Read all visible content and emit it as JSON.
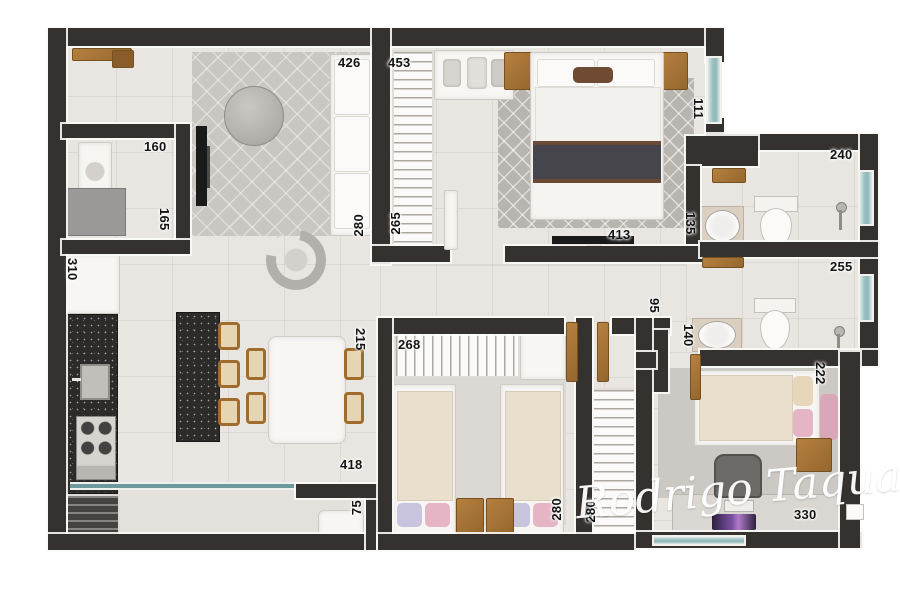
{
  "watermark": "Rodrigo Taquary",
  "colors": {
    "wall": "#35312f",
    "floor": "#e9e6e2",
    "window_teal": "#9fc3c4",
    "glass_door": "#6d989c",
    "wood": "#a9743b",
    "granite": "#2d2b29",
    "pink_pillow": "#e5b5c5",
    "lavender_pillow": "#c9c4dd",
    "beige_blanket": "#e9dfcc"
  },
  "dims": {
    "living_top": "426",
    "living_side": "280",
    "master_wardrobe": "453",
    "master_wardrobe_side": "265",
    "master_bottom": "413",
    "master_window_side": "111",
    "laundry_top": "160",
    "laundry_side": "165",
    "fridge_side": "310",
    "dining_side": "215",
    "balcony_door": "418",
    "balcony_side": "75",
    "bath1_top": "240",
    "bath1_side": "135",
    "bath2_top": "255",
    "bath2_side": "140",
    "hall_side": "95",
    "bedroom2_top": "268",
    "bedroom2_side": "280",
    "closet_side": "280",
    "bedroom3_bottom": "330",
    "bedroom3_side": "222"
  }
}
